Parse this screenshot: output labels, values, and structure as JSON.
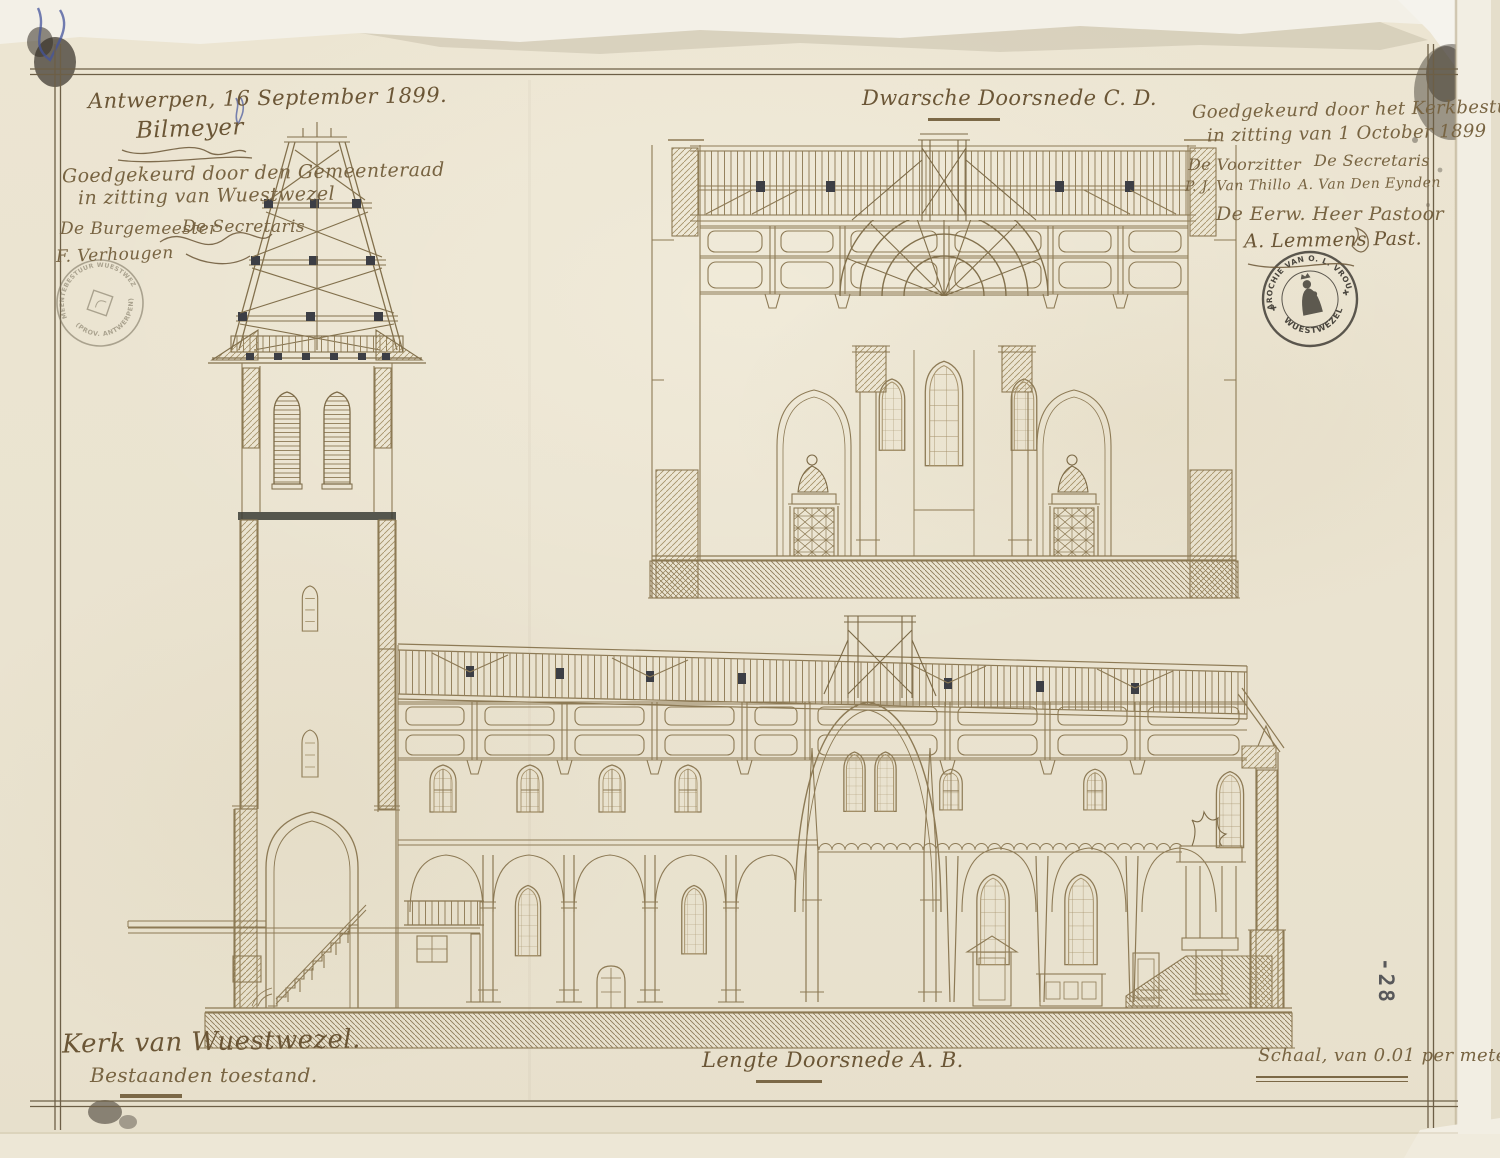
{
  "colors": {
    "paper": "#ebe4d1",
    "ink_script": "#786442",
    "drawing_line": "#8d7a55",
    "dark_accent": "#3c3e45",
    "stamp_ink": "#4a463e",
    "stamp_faint": "#756d59",
    "blue_pencil": "#44549c"
  },
  "annotations": {
    "dateline": "Antwerpen, 16 September 1899.",
    "architect_signature": "Bilmeyer",
    "council_approval": {
      "line1": "Goedgekeurd door den Gemeenteraad",
      "line2": "in zitting van Wuestwezel",
      "left_role": "De Burgemeester",
      "right_role": "De Secretaris",
      "left_signature": "F. Verhougen"
    },
    "board_approval": {
      "line1": "Goedgekeurd door het Kerkbestuur",
      "line2": "in zitting van 1 October 1899",
      "left_role": "De Voorzitter",
      "right_role": "De Secretaris",
      "left_signature": "P. J. Van Thillo",
      "right_signature": "A. Van Den Eynden",
      "pastor_role": "De Eerw. Heer Pastoor",
      "pastor_signature": "A. Lemmens Past."
    },
    "section_titles": {
      "transverse": "Dwarsche Doorsnede C. D.",
      "longitudinal": "Lengte Doorsnede A. B."
    },
    "caption": {
      "title": "Kerk van Wuestwezel.",
      "subtitle": "Bestaanden toestand."
    },
    "scale_note": "Schaal, van 0.01 per meter."
  },
  "stamps": {
    "parish": {
      "arc_top": "PAROCHIE VAN O. L. VROUW",
      "arc_bottom": "WUESTWEZEL",
      "separator": "✚"
    },
    "municipal": {
      "arc_top": "GEMEENTEBESTUUR WUESTWEZEL",
      "arc_bottom": "(PROV. ANTWERPEN)"
    },
    "archive_number": "-28"
  }
}
